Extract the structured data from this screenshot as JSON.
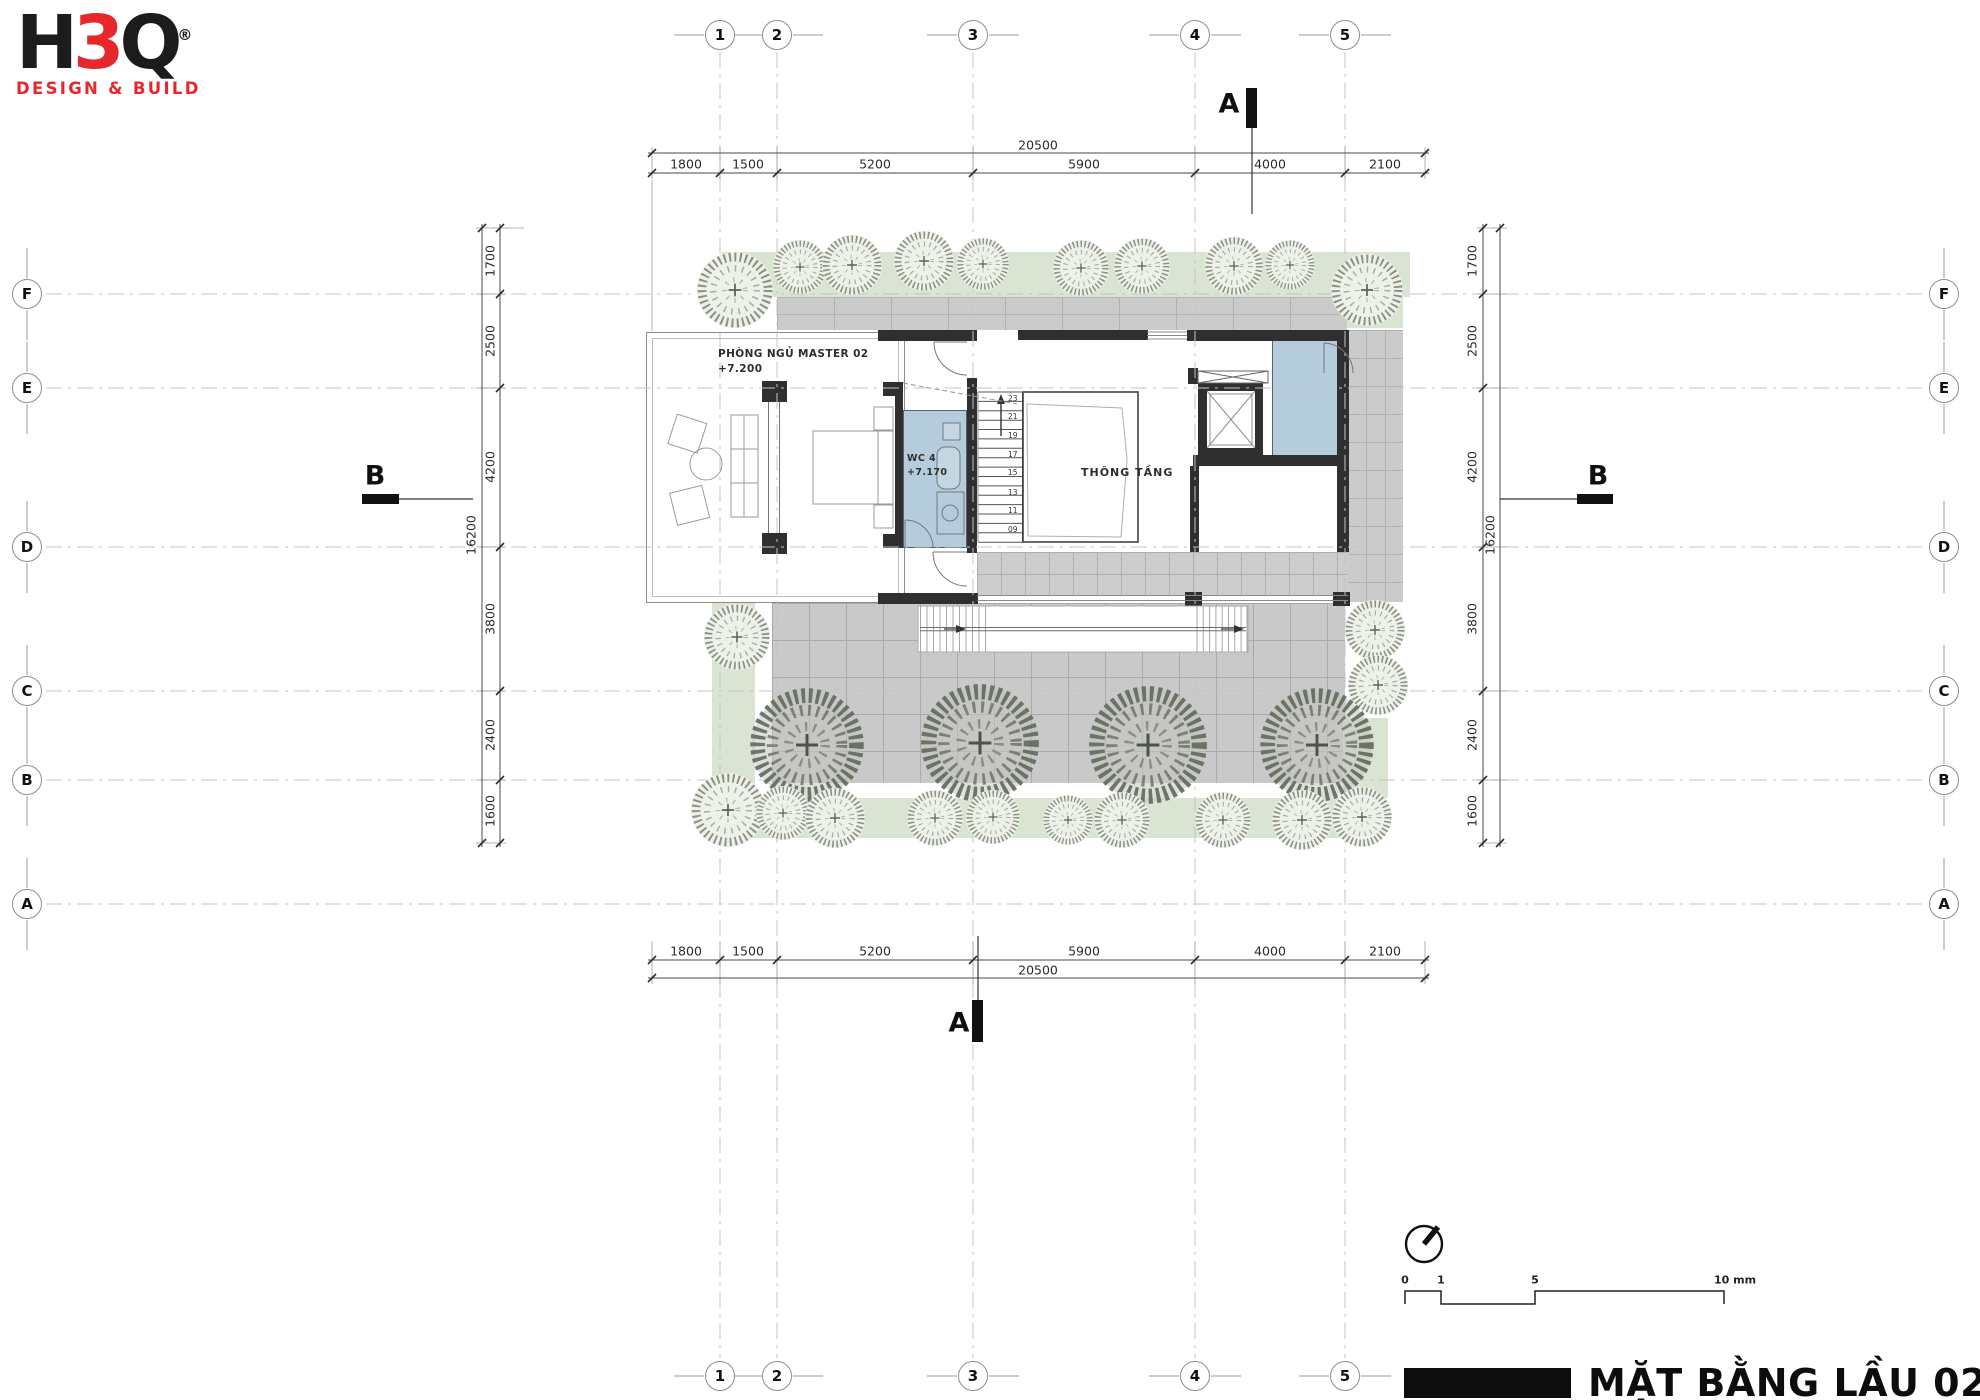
{
  "logo": {
    "h": "H",
    "three": "3",
    "q": "Q",
    "reg": "®",
    "tagline": "DESIGN & BUILD"
  },
  "grid": {
    "cols": [
      "1",
      "2",
      "3",
      "4",
      "5"
    ],
    "rows": [
      "F",
      "E",
      "D",
      "C",
      "B",
      "A"
    ]
  },
  "dims": {
    "top_total": "20500",
    "top_segments": [
      "1800",
      "1500",
      "5200",
      "5900",
      "4000",
      "2100"
    ],
    "bottom_total": "20500",
    "bottom_segments": [
      "1800",
      "1500",
      "5200",
      "5900",
      "4000",
      "2100"
    ],
    "left_total": "16200",
    "left_segments": [
      "1700",
      "2500",
      "4200",
      "3800",
      "2400",
      "1600"
    ],
    "right_total": "16200",
    "right_segments": [
      "1700",
      "2500",
      "4200",
      "3800",
      "2400",
      "1600"
    ]
  },
  "rooms": {
    "master_name": "PHÒNG NGỦ MASTER 02",
    "master_level": "+7.200",
    "wc_name": "WC 4",
    "wc_level": "+7.170",
    "void_name": "THÔNG TẦNG"
  },
  "stairs": {
    "numbers": [
      "23",
      "21",
      "19",
      "17",
      "15",
      "13",
      "11",
      "09"
    ]
  },
  "sections": {
    "a": "A",
    "b": "B"
  },
  "scalebar": {
    "t0": "0",
    "t1": "1",
    "t5": "5",
    "t10": "10 mm"
  },
  "title_block": {
    "title": "MẶT BẰNG LẦU 02"
  },
  "colors": {
    "accent_red": "#e8272d",
    "landscape_green": "#dae4d2",
    "paving_gray": "#cbcbcb",
    "water_blue": "#b4ccdb",
    "wall_black": "#2f2f2f"
  }
}
